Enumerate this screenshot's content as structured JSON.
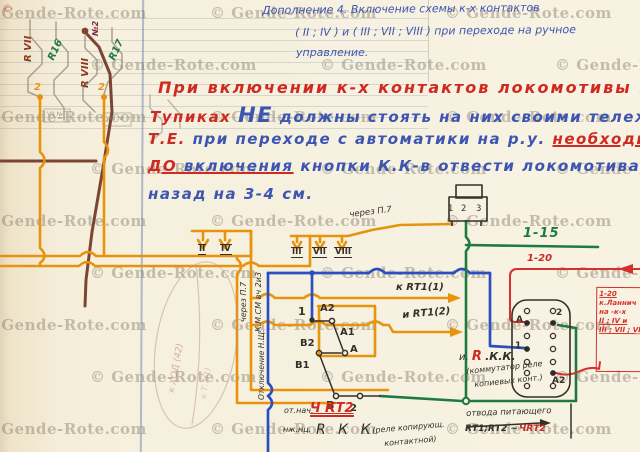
{
  "watermark": {
    "text": "© Gende-Rote.com",
    "copyright_mark": "©"
  },
  "header_note": {
    "l1": "Дополнение 4. Включение схемы к-х контактов",
    "l2": "( II ; IV ) и ( III ; VII ; VIII ) при переходе на ручное",
    "l3": "управление."
  },
  "warning_note": {
    "l1": "При включении к-х контактов локомотивы в",
    "l2_red": "Тупиках",
    "l2_big": "НЕ",
    "l2_rest": "должны стоять на них своими тележками.",
    "l3_red": "Т.Е.",
    "l3_blue": "при переходе с автоматики на р.у.",
    "l3_red2": "необходимо",
    "l4_u1": "ДО",
    "l4_u2": " включения",
    "l4_rest": "кнопки К.К-в отвести локомотива",
    "l5": "назад на 3-4 см."
  },
  "labels": {
    "rvii": "R VII",
    "r16": "R16",
    "rviii": "R VIII",
    "no2": "№2",
    "r17": "R17",
    "two": "2",
    "one": "1",
    "three": "3",
    "vii_n": "VII №",
    "viii_n": "VIII №",
    "ii": "II",
    "iv": "IV",
    "iii": "III",
    "vii": "VII",
    "viii": "VIII",
    "cherez_p7": "через П.7",
    "kmsm": "К.М.СМ вч 2и3",
    "otkl": "Отключение Н.Щ.",
    "k_rt11": "к RТ1(1)",
    "i_rt12": "и RТ1(2)",
    "a": "А",
    "a1": "А1",
    "a2": "А2",
    "b": "В",
    "b1": "В1",
    "b2": "В2",
    "g115": "1-15",
    "r120": "1-20",
    "redbox_l1": "1-20",
    "redbox_l2": "к.Ланнич",
    "redbox_l3": "на -к-х",
    "redbox_l4": "II ; IV и",
    "redbox_l5": "III ; VII ; VIII",
    "irkk_i": "и.",
    "irkk_r": "R",
    "irkk_kk": ".К.К.",
    "irkk_note1": "(коммутатор реле",
    "irkk_note2": "копиевых конт.)",
    "ot_nach": "от.нач.",
    "chkt2": "Ч КТ2",
    "nzh": "нж.нц.",
    "rkk": "R К К",
    "rkk_note1": "(реле копирующ.",
    "rkk_note2": "контактной)",
    "otvoda": "отвода питающего",
    "rt12": "RТ1;RТ2 ~",
    "chrt2": "ЧRТ2",
    "pencil1": "к ХОД (42)",
    "pencil2": "к Т.7(1)"
  },
  "colors": {
    "red_ink": "#cf2a21",
    "blue_ink": "#3d55b2",
    "ink_black": "#35302a",
    "wire_orange": "#e8930e",
    "wire_green": "#1e7a40",
    "wire_blue": "#2b4fc0",
    "wire_brown": "#7c4531",
    "wire_red": "#d5302a",
    "pencil": "#9d9384"
  }
}
